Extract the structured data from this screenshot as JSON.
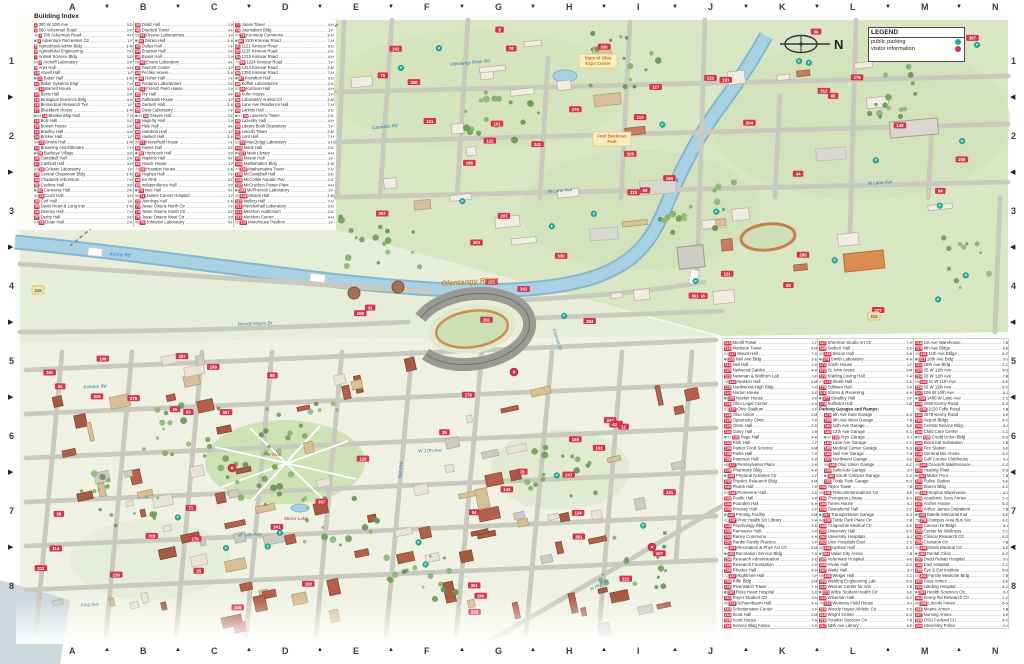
{
  "grid": {
    "top_letters": [
      "A",
      "B",
      "C",
      "D",
      "E",
      "F",
      "G",
      "H",
      "I",
      "J",
      "K",
      "L",
      "M",
      "N"
    ],
    "bottom_letters": [
      "A",
      "B",
      "C",
      "D",
      "E",
      "F",
      "G",
      "H",
      "I",
      "J",
      "K",
      "L",
      "M",
      "N"
    ],
    "left_numbers": [
      "1",
      "2",
      "3",
      "4",
      "5",
      "6",
      "7",
      "8"
    ],
    "right_numbers": [
      "1",
      "2",
      "3",
      "4",
      "5",
      "6",
      "7",
      "8"
    ]
  },
  "compass": {
    "label": "N"
  },
  "legend": {
    "title": "LEGEND",
    "items": [
      {
        "label": "public parking",
        "type": "parking",
        "color": "#1fae9f"
      },
      {
        "label": "visitor information",
        "type": "visitor",
        "color": "#d5344b"
      }
    ]
  },
  "building_index": {
    "title": "Building Index",
    "columns": [
      [
        "300 W 10th Ave",
        "660 Ackerman Road",
        "700 Ackerman Road",
        "Adventure Recreation Ctr",
        "Agricultural Admin Bldg",
        "Agricultural Engineering",
        "Animal Science Bldg",
        "Aronoff Laboratory",
        "Arps Hall",
        "Atwell Hall",
        "Baker Hall",
        "Baker Systems Engr",
        "Barrett House",
        "Bevis Hall",
        "Biological Sciences Bldg",
        "Biomedical Research Twr",
        "Blackburn House",
        "Blankenship Hall",
        "Bolz Hall",
        "Bowen House",
        "Bradley Hall",
        "Bricker Hall",
        "Brown Hall",
        "Browning Amphitheatre",
        "Buckeye Village",
        "Campbell Hall",
        "Canfield Hall",
        "Celeste Laboratory",
        "Central Classroom Bldg",
        "Chadwick Arboretum",
        "Cockins Hall",
        "Converse Hall",
        "Cunz Hall",
        "Curl Hall",
        "Davis Heart & Lung Inst",
        "Denney Hall",
        "Derby Hall",
        "Doan Hall"
      ],
      [
        "Dodd Hall",
        "Drackett Tower",
        "Dreese Laboratories",
        "Drinko Hall",
        "Dulles Hall",
        "Enarson Hall",
        "Evans Hall",
        "Evans Laboratory",
        "Fawcett Center",
        "Fechko House",
        "Fisher Hall",
        "Fontana Laboratories",
        "French Field House",
        "Fry Hall",
        "Galbreath House",
        "Gerlach Hall",
        "Goss Laboratory",
        "Graves Hall",
        "Hagerty Hall",
        "Hale Hall",
        "Hamilton Hall",
        "Haskett Hall",
        "Haverfield House",
        "Hayes Hall",
        "Hitchcock Hall",
        "Hopkins Hall",
        "Houck House",
        "Houston House",
        "Hughes Hall",
        "Ice Rink",
        "Independence Hall",
        "Ives Hall",
        "James Cancer Hospital",
        "Jennings Hall",
        "Jesse Owens North Ctr",
        "Jesse Owens South Ctr",
        "Jesse Owens West Ctr",
        "Johnston Laboratory"
      ],
      [
        "Jones Tower",
        "Journalism Bldg",
        "Kennedy Commons",
        "1100 Kinnear Road",
        "1121 Kinnear Road",
        "1125 Kinnear Road",
        "1212 Kinnear Road",
        "1224 Kinnear Road",
        "1314 Kinnear Road",
        "1350 Kinnear Road",
        "Knowlton Hall",
        "Koffolt Laboratories",
        "Kottman Hall",
        "Kuhn House",
        "Laboratory Animal Ctr",
        "Lane Ave Residence Hall",
        "Larkins Hall",
        "Lawrence Tower",
        "Lazenby Hall",
        "Library Book Depository",
        "Lincoln Tower",
        "Lord Hall",
        "MacQuigg Laboratory",
        "Mack Hall",
        "Main Library",
        "Mason Hall",
        "Mathematics Bldg",
        "Mathematics Tower",
        "McCampbell Hall",
        "McCorkle Aquatic Pav",
        "McCracken Power Plant",
        "McPherson Laboratory",
        "Means Hall",
        "Meiling Hall",
        "Mendenhall Laboratory",
        "Mershon Auditorium",
        "Mershon Center",
        "Morehouse Pavilion"
      ]
    ]
  },
  "building_index2": {
    "columns": [
      [
        "Morrill Tower",
        "Morrison Tower",
        "Mount Hall",
        "Neil Ave Bldg",
        "Neil Hall",
        "Neilwood Gables",
        "Newman & Wolfrom Lab",
        "Newton Hall",
        "Northwood-High Bldg",
        "Norton House",
        "Nosker House",
        "Ohio Legal Center",
        "Ohio Stadium",
        "Ohio Union",
        "Optometry Clinic",
        "Orton Hall",
        "Oxley Hall",
        "Page Hall",
        "Park Hall",
        "Parker Food Science",
        "Parks Hall",
        "Paterson Hall",
        "Pennsylvania Place",
        "Pharmacy Bldg",
        "Physical Activities Ctr",
        "Physics Research Bldg",
        "Plumb Hall",
        "Pomerene Hall",
        "Postle Hall",
        "Pounden Hall",
        "Pressey Hall",
        "Printing Facility",
        "Prior Health Sci Library",
        "Psychology Bldg",
        "Ramseyer Hall",
        "Raney Commons",
        "Rardin Family Practice",
        "Recreation & Phys Act Ctr",
        "Recreation Service Bldg",
        "Research Administration",
        "Research Foundation",
        "Rhodes Hall",
        "Rightmire Hall",
        "Riffe Bldg",
        "Riverwatch Tower",
        "Ross Heart Hospital",
        "Royer Student Ctr",
        "Schoenbaum Hall",
        "Schottenstein Center",
        "Scott Hall",
        "Scott House",
        "Service Bldg Annex"
      ],
      [
        "Sherman Studio Art Ctr",
        "Siebert Hall",
        "Sisson Hall",
        "Smith Laboratory",
        "Smith House",
        "St John Arena",
        "Starling Loving Hall",
        "Steeb Hall",
        "Stillman Hall",
        "Stores & Receiving",
        "Stradley Hall",
        "Sullivant Hall",
        "::Parking Garages and Ramps:",
        "~9th Ave East Garage",
        "~9th Ave West Garage",
        "~11th Ave Garage",
        "~12th Ave Garage",
        "~Arps Garage",
        "~Lane Ave Garage",
        "~Medical Center Garage",
        "~Neil Ave Garage",
        "~Northwest Garage",
        "~Ohio Union Garage",
        "~SafeAuto Garage",
        "~South Campus Garage",
        "~Tuttle Park Garage",
        "Taylor Tower",
        "Telecommunications Ctr",
        "Thompson Library",
        "Torres House",
        "Townshend Hall",
        "Transportation Garage",
        "Tuttle Park Place Ctr",
        "Tzagournis Medical Ctr",
        "University Hall",
        "University Hospitals",
        "Univ Hospitals East",
        "Upham Hall",
        "Value City Arena",
        "Veterinary Hospital",
        "Vivian Hall",
        "Watts Hall",
        "Weigel Hall",
        "Welding Engineering Lab",
        "Wexner Center for Arts",
        "Wilce Student Health Ctr",
        "Wiseman Hall",
        "Womens Field House",
        "Woody Hayes Athletic Ctr",
        "Wright Center",
        "Younkin Success Ctr",
        "18th Ave Library"
      ],
      [
        "1st Ave Warehouse",
        "9th Ave Bldgs",
        "11th Ave Bldgs",
        "18th Ave Bldg",
        "19th Ave Bldg",
        "25 W 11th Ave",
        "33 W 11th Ave",
        "41 W 11th Ave",
        "53 W 11th Ave",
        "109 W 10th Ave",
        "1480 W Lane Ave",
        "2050 Kenny Road",
        "2120 Fyffe Road",
        "2578 Kenny Road",
        "Airport Bldgs",
        "Central Service Bldg",
        "Child Care Center",
        "Credit Union Bldg",
        "Electrical Substation",
        "Fire Station",
        "General Bio Annex",
        "Golf Course Clubhouse",
        "Grounds Maintenance",
        "Heating Plant",
        "Motor Pool",
        "Police Station",
        "Stores Bldg",
        "Surplus Warehouse",
        "Academic Svcs Annex",
        "Archer House",
        "Arthur James Outpatient",
        "Batelle Memorial Inst",
        "Campus Area Bus Svc",
        "Cannon Dr Bldgs",
        "Center for Wellness",
        "Clinical Research Ctr",
        "Cranston Ctr",
        "Davis Medical Ctr",
        "Dental Clinic",
        "Dodd Rehab Hospital",
        "East Hospital",
        "Eye & Ear Institute",
        "Family Medicine Bldg",
        "Goss Annex",
        "Harding Hospital",
        "Health Sciences Ctr",
        "Kenny Rd Research Ctr",
        "Lincoln Annex",
        "Means Annex",
        "Nursing Annex",
        "OSU Federal CU",
        "University Police"
      ]
    ]
  },
  "map": {
    "river_label": {
      "t": "Olentangy River",
      "x": 470,
      "y": 284,
      "r": -4
    },
    "street_labels": [
      {
        "t": "Olentangy River Rd",
        "x": 470,
        "y": 64,
        "r": -5
      },
      {
        "t": "Carmack Rd",
        "x": 385,
        "y": 128,
        "r": -5
      },
      {
        "t": "W Lane Ave",
        "x": 560,
        "y": 192,
        "r": -4
      },
      {
        "t": "W Lane Ave",
        "x": 880,
        "y": 184,
        "r": -4
      },
      {
        "t": "Woody Hayes Dr",
        "x": 255,
        "y": 325,
        "r": -2
      },
      {
        "t": "Cannon Dr",
        "x": 556,
        "y": 340,
        "r": 72
      },
      {
        "t": "Kenny Rd",
        "x": 120,
        "y": 256,
        "r": 4
      },
      {
        "t": "Neil Ave",
        "x": 402,
        "y": 470,
        "r": -85
      },
      {
        "t": "W 12th Ave",
        "x": 250,
        "y": 536,
        "r": -2.5
      },
      {
        "t": "W 17th Ave",
        "x": 430,
        "y": 452,
        "r": -2.5
      },
      {
        "t": "N High St",
        "x": 600,
        "y": 586,
        "r": -29
      },
      {
        "t": "King Ave",
        "x": 90,
        "y": 606,
        "r": -3
      },
      {
        "t": "Kinnear Rd",
        "x": 95,
        "y": 388,
        "r": -3
      }
    ],
    "park_labels": [
      {
        "t": "The Oval",
        "x": 272,
        "y": 456
      },
      {
        "t": "Mirror Lake",
        "x": 296,
        "y": 520
      }
    ],
    "area_boxes": [
      {
        "x": 598,
        "y": 58,
        "lines": [
          "State of Ohio",
          "Expo Center"
        ]
      },
      {
        "x": 612,
        "y": 136,
        "lines": [
          "Fred Beekman",
          "Park"
        ]
      }
    ],
    "route_shields": [
      {
        "t": "315",
        "x": 38,
        "y": 290
      },
      {
        "t": "315",
        "x": 874,
        "y": 316
      }
    ],
    "visitor_markers": [
      [
        232,
        468
      ],
      [
        514,
        372
      ],
      [
        652,
        547
      ]
    ]
  }
}
